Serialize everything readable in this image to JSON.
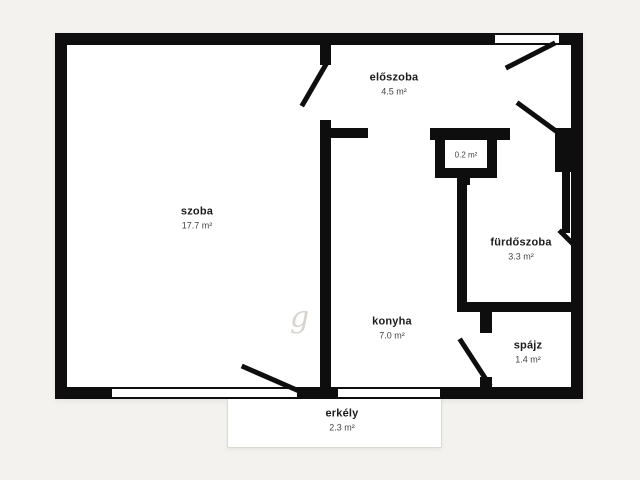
{
  "colors": {
    "background": "#f4f2ef",
    "wall": "#0e0e0e",
    "plan_fill": "#ffffff"
  },
  "rooms": {
    "szoba": {
      "name": "szoba",
      "area": "17.7 m²"
    },
    "eloszoba": {
      "name": "előszoba",
      "area": "4.5 m²"
    },
    "konyha": {
      "name": "konyha",
      "area": "7.0 m²"
    },
    "furdoszoba": {
      "name": "fürdőszoba",
      "area": "3.3 m²"
    },
    "spajz": {
      "name": "spájz",
      "area": "1.4 m²"
    },
    "erkely": {
      "name": "erkély",
      "area": "2.3 m²"
    },
    "closet": {
      "name": "",
      "area": "0.2 m²"
    }
  },
  "watermark": "g"
}
